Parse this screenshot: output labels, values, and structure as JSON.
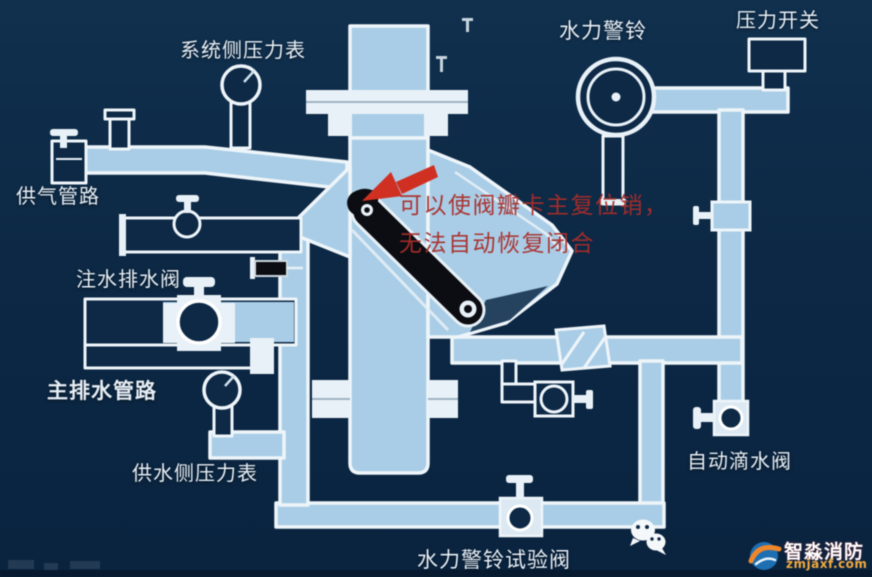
{
  "diagram": {
    "labels": {
      "system_gauge": "系统侧压力表",
      "alarm_bell": "水力警铃",
      "pressure_switch": "压力开关",
      "air_supply": "供气管路",
      "fill_drain_valve": "注水排水阀",
      "main_drain": "主排水管路",
      "supply_gauge": "供水侧压力表",
      "auto_drip_valve": "自动滴水阀",
      "alarm_test_valve": "水力警铃试验阀"
    },
    "annotation": {
      "line1": "可以使阀瓣卡主复位销，",
      "line2": "无法自动恢复闭合"
    },
    "colors": {
      "background": "#0d2a46",
      "pipe_fill": "#a9cde6",
      "pipe_outline": "#eef5fa",
      "clapper_black": "#0b0d12",
      "annotation_red": "#aa2d2a",
      "arrow_red": "#d03022"
    }
  },
  "watermark": {
    "brand": "智淼消防",
    "url": "zmjaxf.com"
  }
}
